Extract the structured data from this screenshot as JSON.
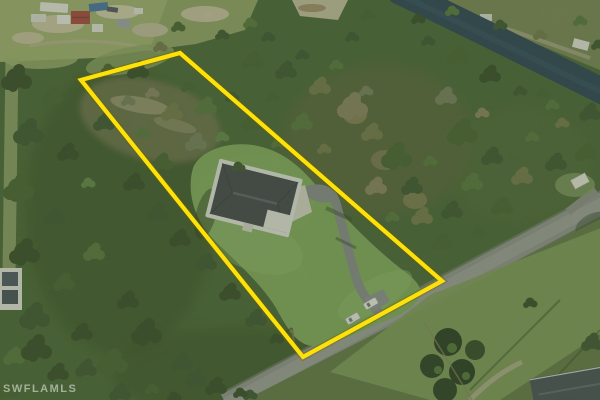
{
  "image": {
    "kind": "aerial drone photograph",
    "subject": "home on a large wooded parcel outlined in yellow, driveway to paved road, canal at top right",
    "watermark": "SWFLAMLS"
  },
  "overlay": {
    "boundary_points": "81,80 180,53 442,281 303,357"
  },
  "colors": {
    "boundary": "#ffe10a",
    "canal_water": "#21394e",
    "forest": "#42602e",
    "lawn": "#7fa958",
    "road": "#8f928d",
    "driveway": "#85888b",
    "roof": "#3a3e45",
    "concrete": "#d9d8cc"
  },
  "objects": {
    "vehicle_count": 2
  }
}
